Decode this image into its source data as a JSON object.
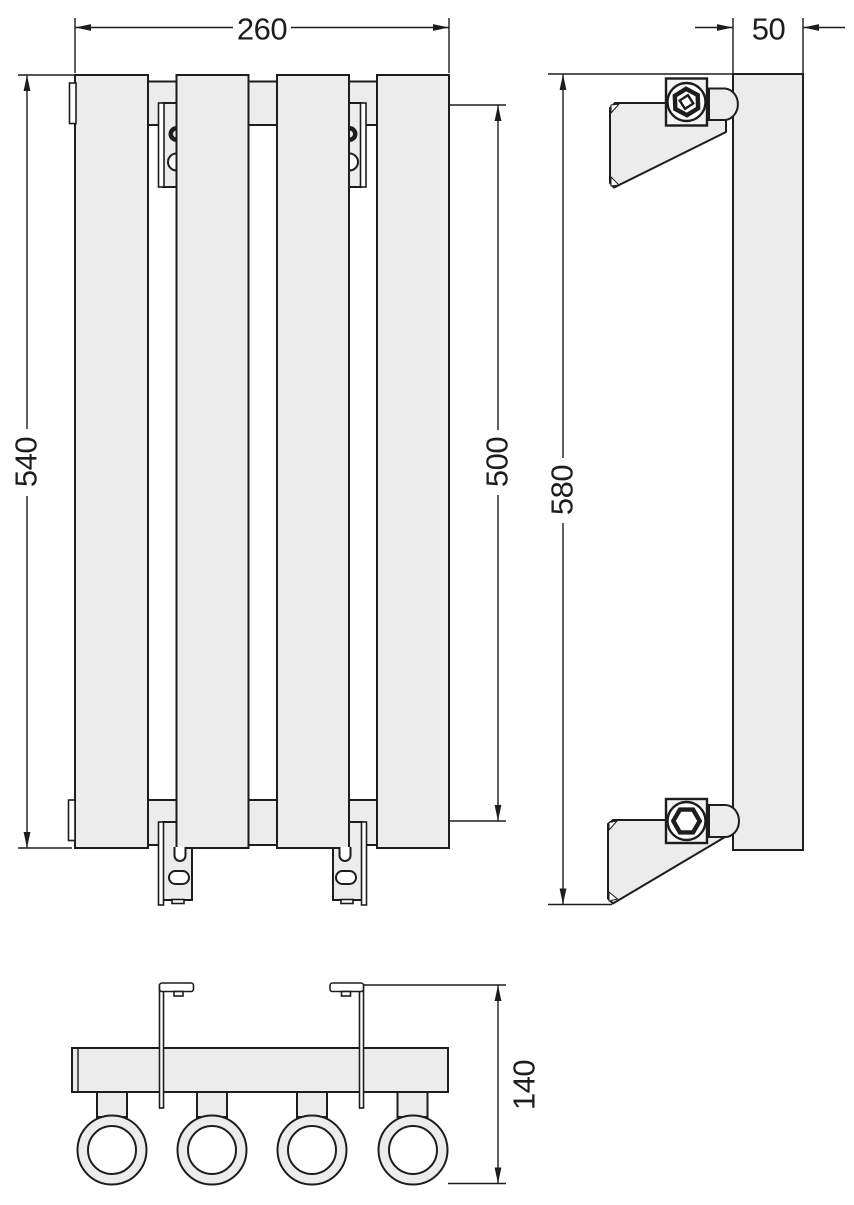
{
  "drawing_type": "radiator-technical-drawing",
  "dimensions": {
    "front_width_mm": "260",
    "front_height_mm": "540",
    "connection_spacing_mm": "500",
    "depth_mm": "50",
    "side_height_mm": "580",
    "wall_depth_mm": "140"
  },
  "colors": {
    "line": "#1d1d1d",
    "fill": "#ececec",
    "background": "#ffffff"
  }
}
